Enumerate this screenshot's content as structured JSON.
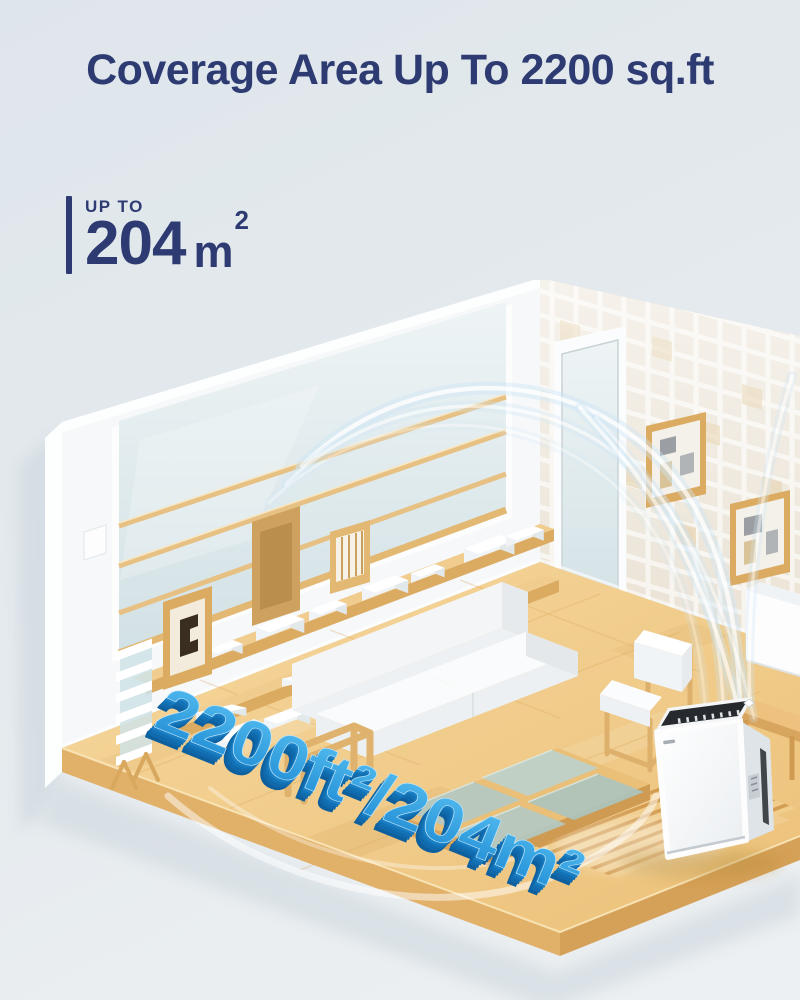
{
  "header": {
    "title": "Coverage Area Up To 2200 sq.ft"
  },
  "coverage": {
    "label": "UP TO",
    "value": "204",
    "unit": "m",
    "unit_exponent": "2"
  },
  "scene": {
    "floor_text": "2200ft²/204m²"
  },
  "colors": {
    "title_navy": "#2e3b72",
    "floor_text_blue": "#2d9fe2",
    "floor_text_depth_blue": "#0f67a6",
    "floor_tan": "#f2cd90",
    "wood_gold": "#dfae6a",
    "glass_teal": "#b3c9c3",
    "airflow_blue": "#cfe7f6",
    "wall_white": "#f7f9fa",
    "tile_beige": "#eae2d4",
    "background": "#e3e9ed"
  }
}
